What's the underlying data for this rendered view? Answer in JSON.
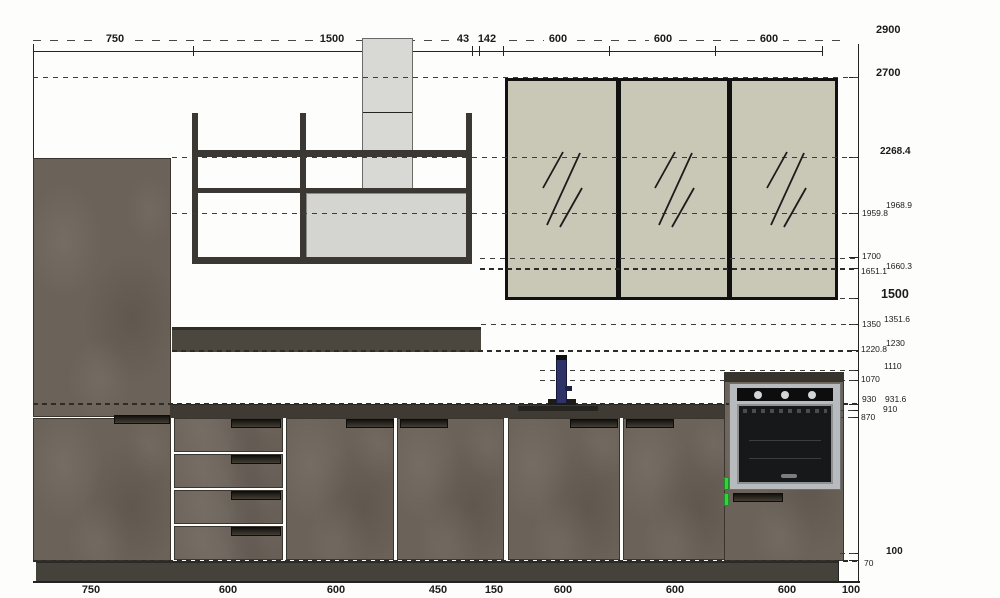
{
  "title": "Kitchen elevation CAD drawing",
  "dims_top": [
    "750",
    "1500",
    "43",
    "142",
    "600",
    "600",
    "600"
  ],
  "dims_right": [
    "2900",
    "2700",
    "2268.4",
    "1968.9",
    "1959.8",
    "1700",
    "1660.3",
    "1651.1",
    "1500",
    "1351.6",
    "1350",
    "1230",
    "1220.8",
    "1110",
    "1070",
    "930",
    "931.6",
    "910",
    "870",
    "100",
    "70"
  ],
  "dims_bottom": [
    "750",
    "600",
    "600",
    "450",
    "150",
    "600",
    "600",
    "600",
    "100"
  ],
  "colors": {
    "cabinet_brown": "#6b6259",
    "plinth_dark": "#45423b",
    "glass_fill": "#c9c7b6",
    "hood_gray": "#d6d6d3",
    "faucet_navy": "#2d3366",
    "selection_green": "#35d23c",
    "oven_steel": "#b8bbbd",
    "line_dark": "#232323"
  }
}
